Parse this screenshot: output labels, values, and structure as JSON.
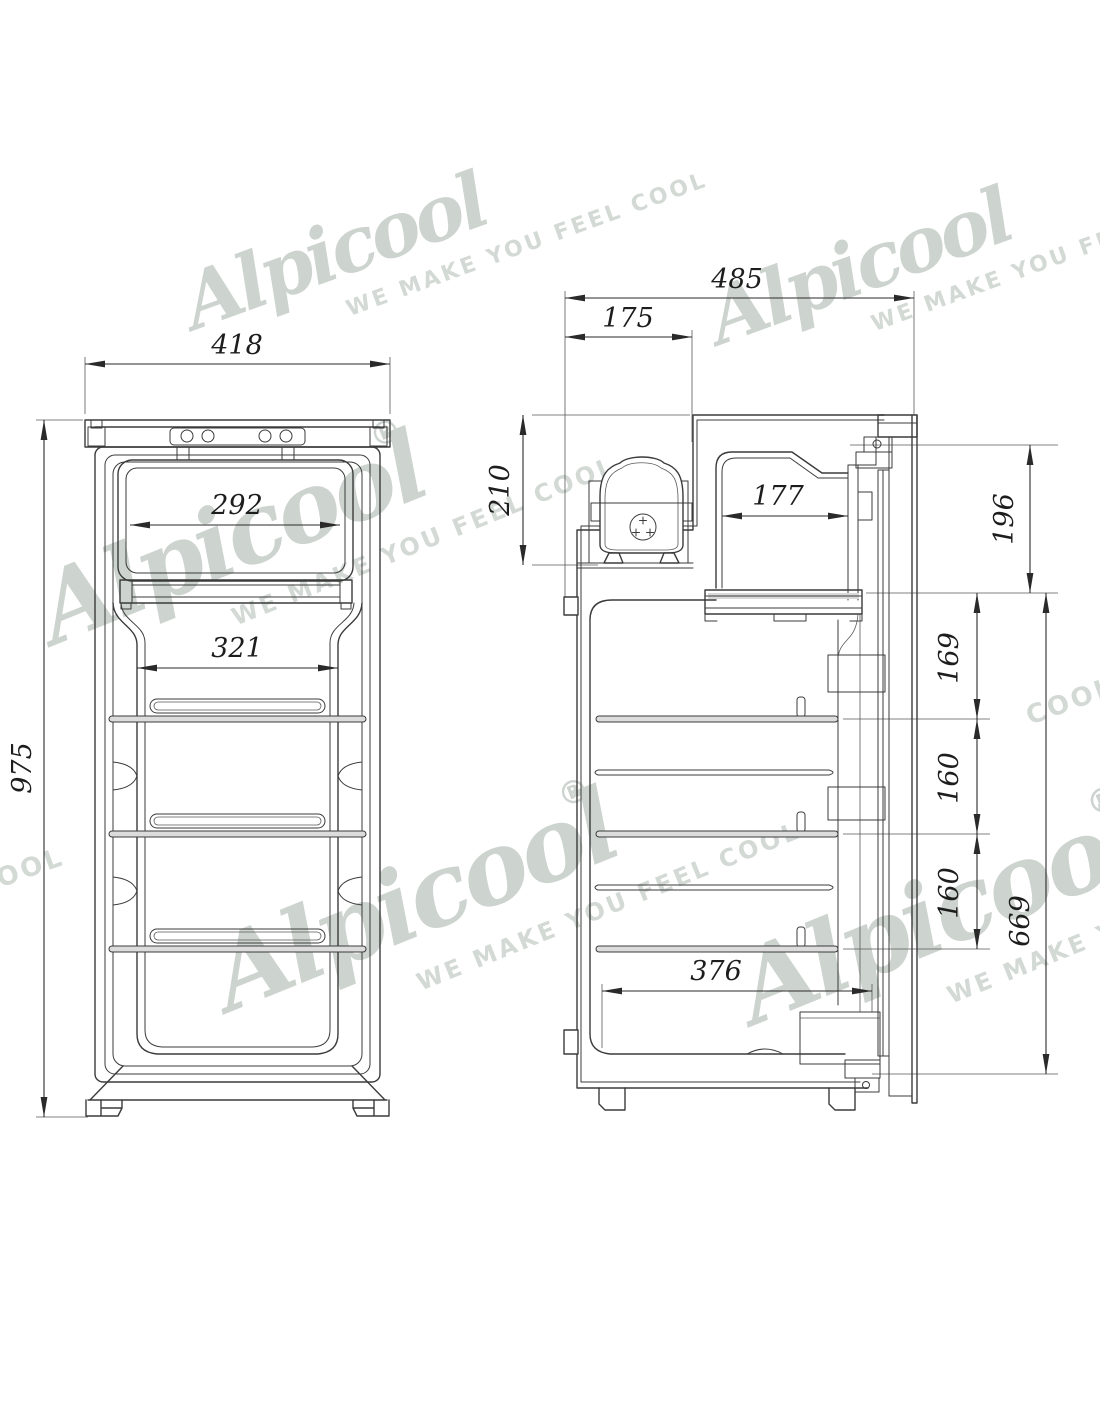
{
  "page": {
    "background_color": "#ffffff"
  },
  "brand": {
    "name": "Alpicool",
    "registered_mark": "®",
    "tagline": "WE MAKE YOU FEEL COOL",
    "fragment_left": "L COOL",
    "fragment_right": "COOL",
    "watermark_color": "#cdd4cf"
  },
  "drawing": {
    "line_color": "#3b3b3b",
    "dimension_color": "#2a2a2a",
    "front_view": {
      "overall_width": "418",
      "freezer_opening_width": "292",
      "shelf_width": "321",
      "overall_height": "975"
    },
    "side_view": {
      "overall_depth": "485",
      "compressor_recess_depth": "175",
      "compressor_recess_height": "210",
      "freezer_inner_depth": "177",
      "freezer_front_height": "196",
      "top_shelf_gap": "169",
      "middle_shelf_gap": "160",
      "lower_shelf_gap": "160",
      "interior_height": "669",
      "interior_floor_depth": "376"
    }
  }
}
